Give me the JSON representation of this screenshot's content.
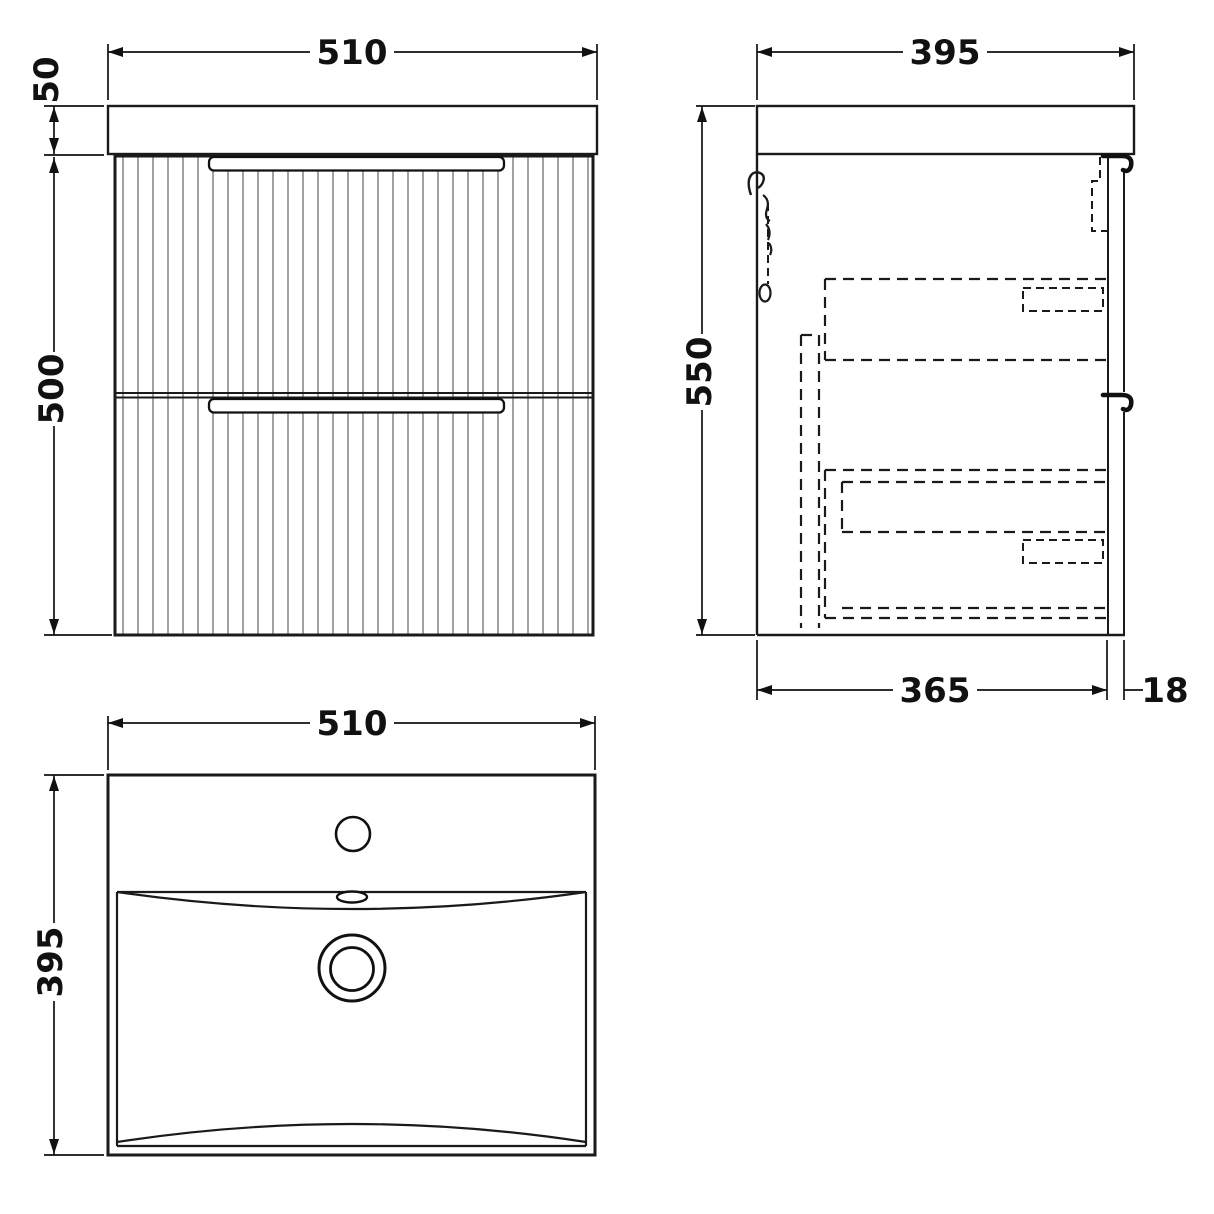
{
  "drawing": {
    "type": "vanity-unit-technical-drawing",
    "colors": {
      "line": "#1a1a1a",
      "flute": "#8a8a8a",
      "background": "#ffffff",
      "text": "#111111"
    },
    "front_view": {
      "width_label": "510",
      "countertop_height_label": "50",
      "cabinet_height_label": "500"
    },
    "side_view": {
      "width_label": "395",
      "height_label": "550",
      "depth_label": "365",
      "front_thickness_label": "18"
    },
    "plan_view": {
      "width_label": "510",
      "depth_label": "395"
    }
  }
}
